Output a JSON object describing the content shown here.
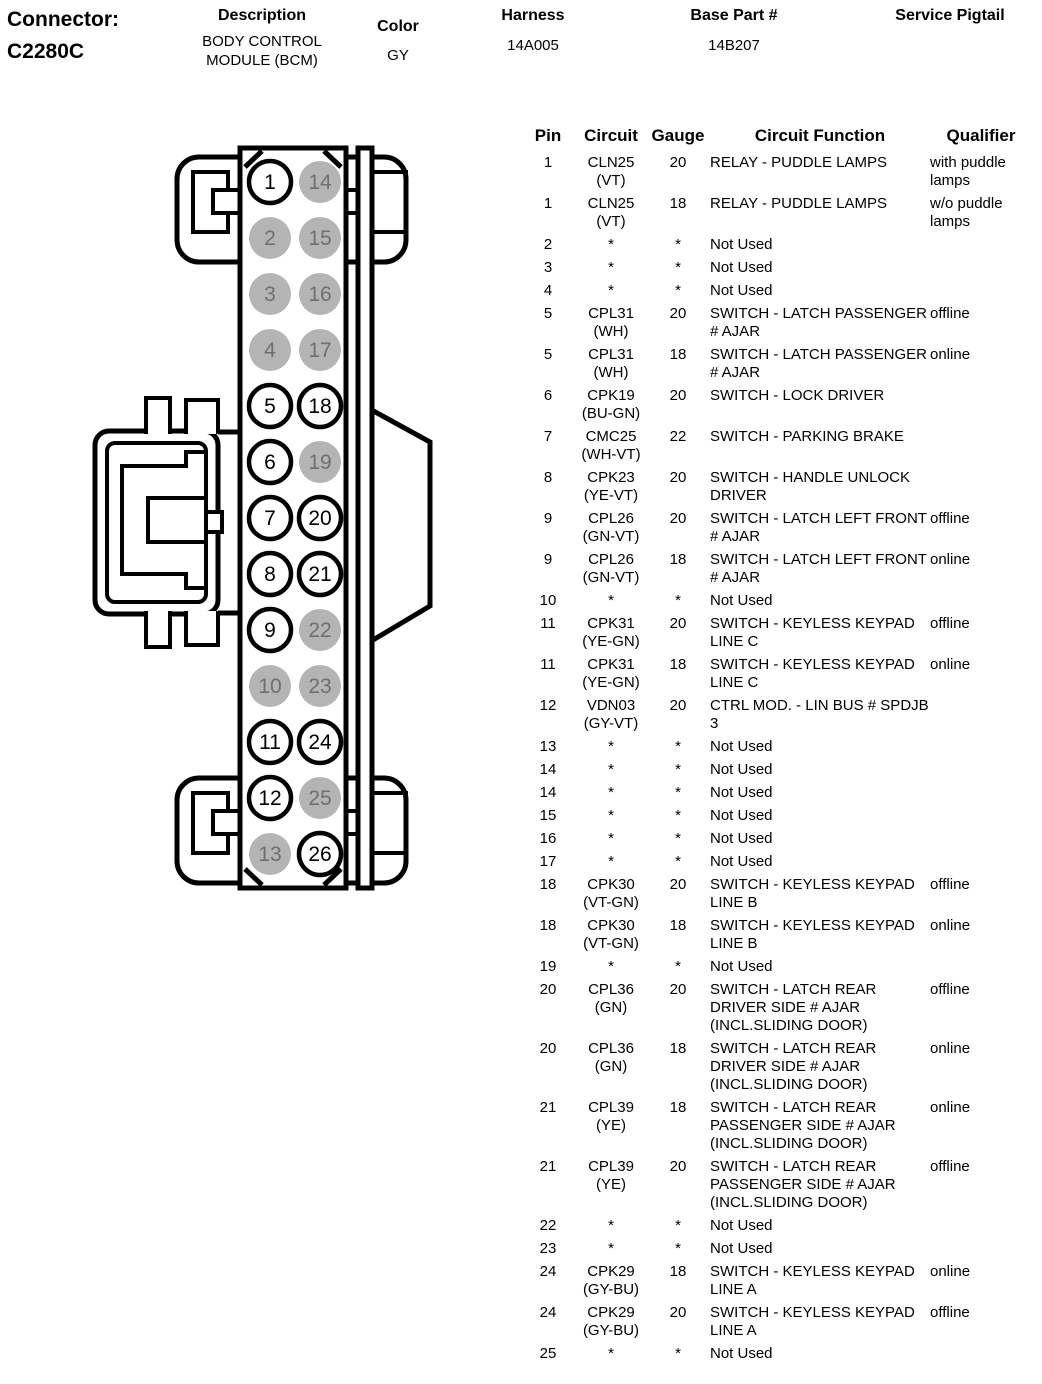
{
  "header": {
    "connector_label": "Connector:",
    "connector_id": "C2280C",
    "description_label": "Description",
    "description_line1": "BODY CONTROL",
    "description_line2": "MODULE (BCM)",
    "color_label": "Color",
    "color_value": "GY",
    "harness_label": "Harness",
    "harness_value": "14A005",
    "base_part_label": "Base Part #",
    "base_part_value": "14B207",
    "service_pigtail_label": "Service Pigtail"
  },
  "connector_diagram": {
    "pin_fill_used": "#ffffff",
    "pin_fill_not_used": "#b4b4b4",
    "pin_text_used": "#000000",
    "pin_text_not_used": "#6f6f6f",
    "outline_color": "#000000",
    "pins": [
      {
        "number": 1,
        "used": true
      },
      {
        "number": 2,
        "used": false
      },
      {
        "number": 3,
        "used": false
      },
      {
        "number": 4,
        "used": false
      },
      {
        "number": 5,
        "used": true
      },
      {
        "number": 6,
        "used": true
      },
      {
        "number": 7,
        "used": true
      },
      {
        "number": 8,
        "used": true
      },
      {
        "number": 9,
        "used": true
      },
      {
        "number": 10,
        "used": false
      },
      {
        "number": 11,
        "used": true
      },
      {
        "number": 12,
        "used": true
      },
      {
        "number": 13,
        "used": false
      },
      {
        "number": 14,
        "used": false
      },
      {
        "number": 15,
        "used": false
      },
      {
        "number": 16,
        "used": false
      },
      {
        "number": 17,
        "used": false
      },
      {
        "number": 18,
        "used": true
      },
      {
        "number": 19,
        "used": false
      },
      {
        "number": 20,
        "used": true
      },
      {
        "number": 21,
        "used": true
      },
      {
        "number": 22,
        "used": false
      },
      {
        "number": 23,
        "used": false
      },
      {
        "number": 24,
        "used": true
      },
      {
        "number": 25,
        "used": false
      },
      {
        "number": 26,
        "used": true
      }
    ]
  },
  "table": {
    "headers": [
      "Pin",
      "Circuit",
      "Gauge",
      "Circuit Function",
      "Qualifier"
    ],
    "rows": [
      {
        "pin": "1",
        "circuit": "CLN25",
        "color": "(VT)",
        "gauge": "20",
        "function": "RELAY - PUDDLE LAMPS",
        "qualifier": "with puddle lamps"
      },
      {
        "pin": "1",
        "circuit": "CLN25",
        "color": "(VT)",
        "gauge": "18",
        "function": "RELAY - PUDDLE LAMPS",
        "qualifier": "w/o puddle lamps"
      },
      {
        "pin": "2",
        "circuit": "*",
        "color": "",
        "gauge": "*",
        "function": "Not Used",
        "qualifier": ""
      },
      {
        "pin": "3",
        "circuit": "*",
        "color": "",
        "gauge": "*",
        "function": "Not Used",
        "qualifier": ""
      },
      {
        "pin": "4",
        "circuit": "*",
        "color": "",
        "gauge": "*",
        "function": "Not Used",
        "qualifier": ""
      },
      {
        "pin": "5",
        "circuit": "CPL31",
        "color": "(WH)",
        "gauge": "20",
        "function": "SWITCH - LATCH PASSENGER # AJAR",
        "qualifier": "offline"
      },
      {
        "pin": "5",
        "circuit": "CPL31",
        "color": "(WH)",
        "gauge": "18",
        "function": "SWITCH - LATCH PASSENGER # AJAR",
        "qualifier": "online"
      },
      {
        "pin": "6",
        "circuit": "CPK19",
        "color": "(BU-GN)",
        "gauge": "20",
        "function": "SWITCH - LOCK DRIVER",
        "qualifier": ""
      },
      {
        "pin": "7",
        "circuit": "CMC25",
        "color": "(WH-VT)",
        "gauge": "22",
        "function": "SWITCH - PARKING BRAKE",
        "qualifier": ""
      },
      {
        "pin": "8",
        "circuit": "CPK23",
        "color": "(YE-VT)",
        "gauge": "20",
        "function": "SWITCH - HANDLE UNLOCK DRIVER",
        "qualifier": ""
      },
      {
        "pin": "9",
        "circuit": "CPL26",
        "color": "(GN-VT)",
        "gauge": "20",
        "function": "SWITCH - LATCH LEFT FRONT # AJAR",
        "qualifier": "offline"
      },
      {
        "pin": "9",
        "circuit": "CPL26",
        "color": "(GN-VT)",
        "gauge": "18",
        "function": "SWITCH - LATCH LEFT FRONT # AJAR",
        "qualifier": "online"
      },
      {
        "pin": "10",
        "circuit": "*",
        "color": "",
        "gauge": "*",
        "function": "Not Used",
        "qualifier": ""
      },
      {
        "pin": "11",
        "circuit": "CPK31",
        "color": "(YE-GN)",
        "gauge": "20",
        "function": "SWITCH - KEYLESS KEYPAD LINE C",
        "qualifier": "offline"
      },
      {
        "pin": "11",
        "circuit": "CPK31",
        "color": "(YE-GN)",
        "gauge": "18",
        "function": "SWITCH - KEYLESS KEYPAD LINE C",
        "qualifier": "online"
      },
      {
        "pin": "12",
        "circuit": "VDN03",
        "color": "(GY-VT)",
        "gauge": "20",
        "function": "CTRL MOD. - LIN BUS # SPDJB 3",
        "qualifier": ""
      },
      {
        "pin": "13",
        "circuit": "*",
        "color": "",
        "gauge": "*",
        "function": "Not Used",
        "qualifier": ""
      },
      {
        "pin": "14",
        "circuit": "*",
        "color": "",
        "gauge": "*",
        "function": "Not Used",
        "qualifier": ""
      },
      {
        "pin": "14",
        "circuit": "*",
        "color": "",
        "gauge": "*",
        "function": "Not Used",
        "qualifier": ""
      },
      {
        "pin": "15",
        "circuit": "*",
        "color": "",
        "gauge": "*",
        "function": "Not Used",
        "qualifier": ""
      },
      {
        "pin": "16",
        "circuit": "*",
        "color": "",
        "gauge": "*",
        "function": "Not Used",
        "qualifier": ""
      },
      {
        "pin": "17",
        "circuit": "*",
        "color": "",
        "gauge": "*",
        "function": "Not Used",
        "qualifier": ""
      },
      {
        "pin": "18",
        "circuit": "CPK30",
        "color": "(VT-GN)",
        "gauge": "20",
        "function": "SWITCH - KEYLESS KEYPAD LINE B",
        "qualifier": "offline"
      },
      {
        "pin": "18",
        "circuit": "CPK30",
        "color": "(VT-GN)",
        "gauge": "18",
        "function": "SWITCH - KEYLESS KEYPAD LINE B",
        "qualifier": "online"
      },
      {
        "pin": "19",
        "circuit": "*",
        "color": "",
        "gauge": "*",
        "function": "Not Used",
        "qualifier": ""
      },
      {
        "pin": "20",
        "circuit": "CPL36",
        "color": "(GN)",
        "gauge": "20",
        "function": "SWITCH - LATCH REAR DRIVER SIDE # AJAR (INCL.SLIDING DOOR)",
        "qualifier": "offline"
      },
      {
        "pin": "20",
        "circuit": "CPL36",
        "color": "(GN)",
        "gauge": "18",
        "function": "SWITCH - LATCH REAR DRIVER SIDE # AJAR (INCL.SLIDING DOOR)",
        "qualifier": "online"
      },
      {
        "pin": "21",
        "circuit": "CPL39",
        "color": "(YE)",
        "gauge": "18",
        "function": "SWITCH - LATCH REAR PASSENGER SIDE # AJAR (INCL.SLIDING DOOR)",
        "qualifier": "online"
      },
      {
        "pin": "21",
        "circuit": "CPL39",
        "color": "(YE)",
        "gauge": "20",
        "function": "SWITCH - LATCH REAR PASSENGER SIDE # AJAR (INCL.SLIDING DOOR)",
        "qualifier": "offline"
      },
      {
        "pin": "22",
        "circuit": "*",
        "color": "",
        "gauge": "*",
        "function": "Not Used",
        "qualifier": ""
      },
      {
        "pin": "23",
        "circuit": "*",
        "color": "",
        "gauge": "*",
        "function": "Not Used",
        "qualifier": ""
      },
      {
        "pin": "24",
        "circuit": "CPK29",
        "color": "(GY-BU)",
        "gauge": "18",
        "function": "SWITCH - KEYLESS KEYPAD LINE A",
        "qualifier": "online"
      },
      {
        "pin": "24",
        "circuit": "CPK29",
        "color": "(GY-BU)",
        "gauge": "20",
        "function": "SWITCH - KEYLESS KEYPAD LINE A",
        "qualifier": "offline"
      },
      {
        "pin": "25",
        "circuit": "*",
        "color": "",
        "gauge": "*",
        "function": "Not Used",
        "qualifier": ""
      }
    ]
  }
}
